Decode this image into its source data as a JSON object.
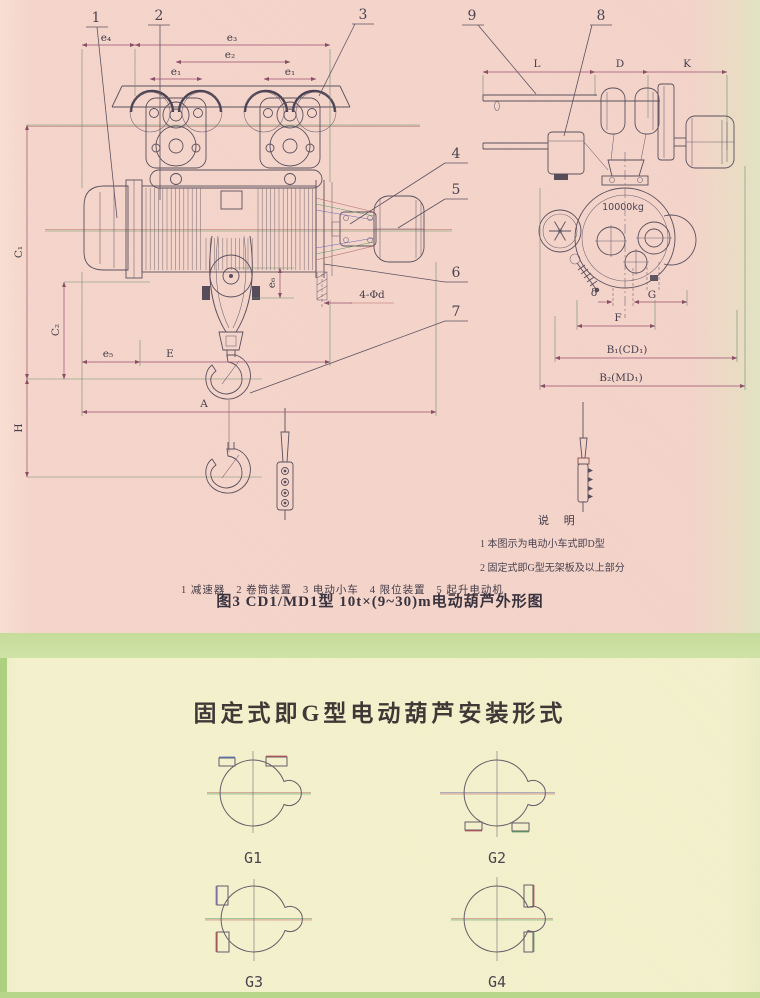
{
  "top": {
    "callout_1": "1",
    "callout_2": "2",
    "callout_3": "3",
    "callout_4": "4",
    "callout_5": "5",
    "callout_6": "6",
    "callout_7": "7",
    "callout_8": "8",
    "callout_9": "9",
    "dim_e4": "e₄",
    "dim_e3": "e₃",
    "dim_e2": "e₂",
    "dim_e1_left": "e₁",
    "dim_e1_right": "e₁",
    "dim_C1": "C₁",
    "dim_C2": "C₂",
    "dim_H": "H",
    "dim_e5": "e₅",
    "dim_E": "E",
    "dim_A": "A",
    "dim_e6": "e₆",
    "dim_bolt_holes": "4-Φd",
    "dim_L": "L",
    "dim_D": "D",
    "dim_K": "K",
    "dim_delta": "δ",
    "dim_G": "G",
    "dim_F": "F",
    "dim_B1": "B₁(CD₁)",
    "dim_B2": "B₂(MD₁)",
    "load_label": "10000kg",
    "legend_row1": "1 减速器   2 卷筒装置   3 电动小车   4 限位装置   5 起升电动机",
    "legend_row2": "6 导绳器   7 吊钩装置   8 电控箱    9 软缆引入器",
    "caption": "图3 CD1/MD1型 10t×(9~30)m电动葫芦外形图",
    "notes_title": "说  明",
    "note_1": "1 本图示为电动小车式即D型",
    "note_2": "2 固定式即G型无架板及以上部分"
  },
  "bottom": {
    "title": "固定式即G型电动葫芦安装形式",
    "variant_g1": "G1",
    "variant_g2": "G2",
    "variant_g3": "G3",
    "variant_g4": "G4"
  }
}
